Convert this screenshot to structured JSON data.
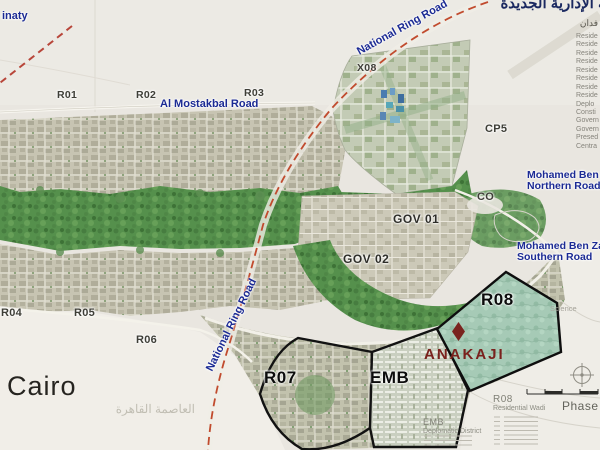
{
  "map": {
    "arabic_title": "العاصمة الإدارية الجديدة",
    "legend": {
      "header_arabic": "فدان",
      "items": [
        "Reside",
        "Reside",
        "Reside",
        "Reside",
        "Reside",
        "Reside",
        "Reside",
        "Reside",
        "Deplo",
        "Consti",
        "Govern",
        "Govern",
        "Presed",
        "Centra"
      ]
    },
    "roads": {
      "madinaty": "inaty",
      "national_ring_top": "National Ring Road",
      "national_ring_mid": "National Ring Road",
      "al_mostakbal": "Al Mostakbal Road",
      "mbz_north_line1": "Mohamed Ben Za",
      "mbz_north_line2": "Northern Road",
      "mbz_south_line1": "Mohamed Ben Zaye",
      "mbz_south_line2": "Southern Road"
    },
    "districts": {
      "r01": "R01",
      "r02": "R02",
      "r03": "R03",
      "r04": "R04",
      "r05": "R05",
      "r06": "R06",
      "r07": "R07",
      "r08": "R08",
      "emb": "EMB",
      "x08": "X08",
      "cp5": "CP5",
      "co": "CO",
      "gov01": "GOV 01",
      "gov02": "GOV 02"
    },
    "watermark": {
      "city": "Cairo",
      "arabic": "العاصمة القاهرة"
    },
    "annotations": {
      "science": "Science",
      "phase": "Phase",
      "r08_title": "R08",
      "r08_subtitle": "Residential Wadi",
      "emb_title": "EMB",
      "emb_subtitle": "Deplomatic District"
    },
    "logo": {
      "name": "ANAKAJI"
    },
    "colors": {
      "road_label_blue": "#1b2a94",
      "ring_road_dash_red": "#c14b2e",
      "district_label_gray": "#3e3e37",
      "bold_black": "#0c0c0c",
      "logo_maroon": "#7a211d",
      "r08_teal_fill": "#a6cab6",
      "green_river": "#55904c",
      "note_gray": "#8d8d83"
    }
  }
}
